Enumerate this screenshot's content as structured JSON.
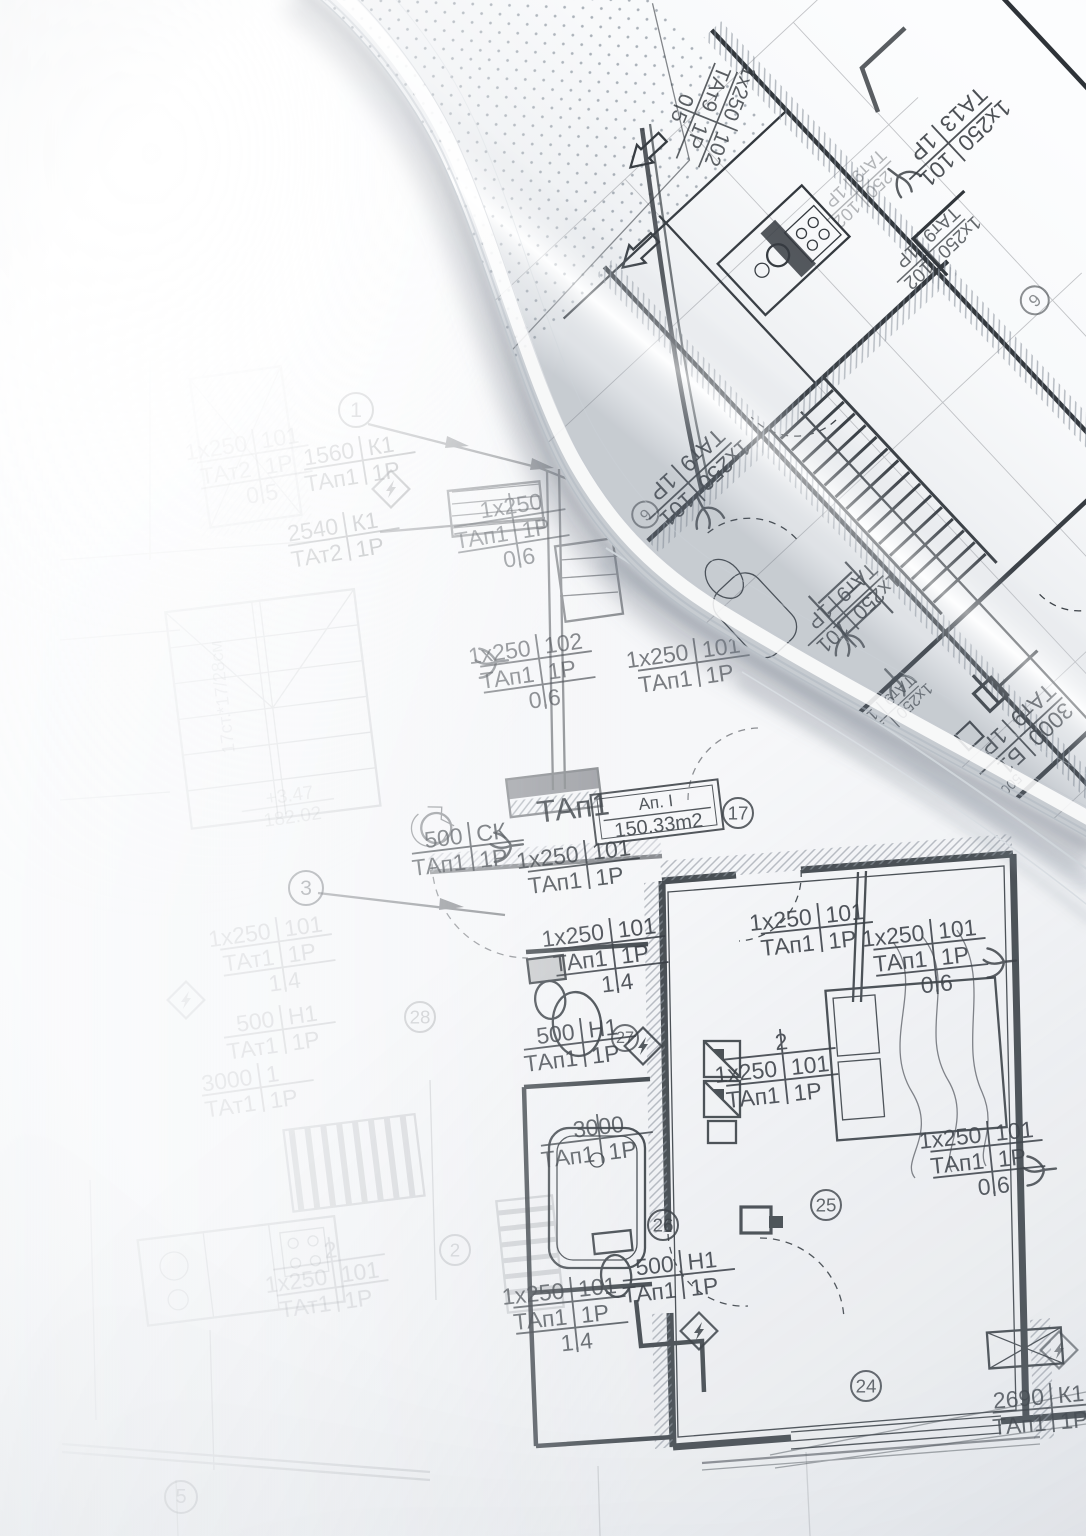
{
  "palette": {
    "ink": "#363b41",
    "roll_ink": "#2e3338",
    "paper": "#f6f7f9",
    "roll_paper": "#fcfdfe",
    "shadow": "#6c7684"
  },
  "flat_plan": {
    "labels": [
      {
        "rows": [
          "1х250|101",
          "ТАт2|1Р",
          "0.5"
        ],
        "x": 255,
        "y": 468,
        "rot": -9,
        "size": 23,
        "o": 0.3
      },
      {
        "rows": [
          "1560|К1",
          "ТАп1|1Р"
        ],
        "x": 360,
        "y": 462,
        "rot": -9,
        "size": 23,
        "o": 0.55
      },
      {
        "rows": [
          "2540|К1",
          "ТАт2|1Р"
        ],
        "x": 344,
        "y": 538,
        "rot": -9,
        "size": 23,
        "o": 0.55
      },
      {
        "rows": [
          "1х250",
          "ТАп1|1Р",
          "0.6"
        ],
        "x": 512,
        "y": 532,
        "rot": -9,
        "size": 23,
        "o": 0.6
      },
      {
        "rows": [
          "1х250|102",
          "ТАп1|1Р",
          "0.6"
        ],
        "x": 538,
        "y": 673,
        "rot": -8,
        "size": 23,
        "o": 0.65
      },
      {
        "rows": [
          "1х250|101",
          "ТАп1|1Р"
        ],
        "x": 694,
        "y": 664,
        "rot": -8,
        "size": 23,
        "o": 0.65
      },
      {
        "rows": [
          "ТАп1"
        ],
        "x": 570,
        "y": 808,
        "rot": -7,
        "size": 31,
        "o": 0.85
      },
      {
        "rows": [
          "500|СК",
          "ТАп1|1Р"
        ],
        "x": 468,
        "y": 848,
        "rot": -7,
        "size": 23,
        "o": 0.8
      },
      {
        "rows": [
          "1х250|101",
          "ТАп1|1Р"
        ],
        "x": 584,
        "y": 866,
        "rot": -7,
        "size": 23,
        "o": 0.85
      },
      {
        "rows": [
          "1х250|101",
          "ТАт1|1Р",
          "1.4"
        ],
        "x": 278,
        "y": 956,
        "rot": -8,
        "size": 23,
        "o": 0.22
      },
      {
        "rows": [
          "500|Н1",
          "ТАт1|1Р"
        ],
        "x": 280,
        "y": 1031,
        "rot": -8,
        "size": 23,
        "o": 0.22
      },
      {
        "rows": [
          "3000|1",
          "ТАт1|1Р"
        ],
        "x": 258,
        "y": 1089,
        "rot": -8,
        "size": 23,
        "o": 0.22
      },
      {
        "rows": [
          "1х250|101",
          "ТАп1|1Р",
          "1.4"
        ],
        "x": 611,
        "y": 957,
        "rot": -7,
        "size": 23,
        "o": 0.88
      },
      {
        "rows": [
          "500|Н1",
          "ТАп1|1Р"
        ],
        "x": 580,
        "y": 1044,
        "rot": -7,
        "size": 23,
        "o": 0.88
      },
      {
        "rows": [
          "1х250|101",
          "ТАп1|1Р"
        ],
        "x": 817,
        "y": 929,
        "rot": -6,
        "size": 23,
        "o": 0.88
      },
      {
        "rows": [
          "1х250|101",
          "ТАп1|1Р",
          "0.6"
        ],
        "x": 931,
        "y": 958,
        "rot": -6,
        "size": 23,
        "o": 0.88
      },
      {
        "rows": [
          "2",
          "1х250|101",
          "ТАп1|1Р"
        ],
        "x": 781,
        "y": 1068,
        "rot": -6,
        "size": 23,
        "o": 0.88
      },
      {
        "rows": [
          "3000",
          "ТАп1|1Р"
        ],
        "x": 597,
        "y": 1140,
        "rot": -7,
        "size": 23,
        "o": 0.8
      },
      {
        "rows": [
          "1х250|101",
          "ТАп1|1Р",
          "0.6"
        ],
        "x": 988,
        "y": 1160,
        "rot": -6,
        "size": 23,
        "o": 0.88
      },
      {
        "rows": [
          "500|Н1",
          "ТАп1|1Р"
        ],
        "x": 679,
        "y": 1276,
        "rot": -6,
        "size": 23,
        "o": 0.88
      },
      {
        "rows": [
          "1х250|101",
          "ТАп1|1Р",
          "1.4"
        ],
        "x": 571,
        "y": 1316,
        "rot": -6,
        "size": 23,
        "o": 0.8
      },
      {
        "rows": [
          "2",
          "1х250|101",
          "ТАт1|1Р"
        ],
        "x": 331,
        "y": 1276,
        "rot": -8,
        "size": 23,
        "o": 0.2
      },
      {
        "rows": [
          "2690|К1",
          "ТАп1|1Р"
        ],
        "x": 1049,
        "y": 1409,
        "rot": -5,
        "size": 23,
        "o": 0.8
      },
      {
        "rows": [
          "+3.47",
          "182.02"
        ],
        "x": 288,
        "y": 806,
        "rot": -8,
        "size": 19,
        "o": 0.14
      },
      {
        "rows": [
          "17ст.*17/28см"
        ],
        "x": 222,
        "y": 700,
        "rot": -97,
        "size": 18,
        "o": 0.16
      }
    ],
    "area_box": {
      "rows": [
        "Ап. I",
        "150.33m2"
      ],
      "x": 657,
      "y": 812,
      "rot": -7,
      "o": 0.85
    },
    "circles": [
      {
        "n": "1",
        "x": 356,
        "y": 410,
        "r": 17,
        "o": 0.55
      },
      {
        "n": "3",
        "x": 306,
        "y": 888,
        "r": 17,
        "o": 0.6
      },
      {
        "n": "17",
        "x": 738,
        "y": 813,
        "r": 15,
        "o": 0.8
      },
      {
        "n": "28",
        "x": 420,
        "y": 1017,
        "r": 15,
        "o": 0.25
      },
      {
        "n": "27",
        "x": 625,
        "y": 1038,
        "r": 13,
        "o": 0.75
      },
      {
        "n": "2",
        "x": 455,
        "y": 1250,
        "r": 15,
        "o": 0.2
      },
      {
        "n": "26",
        "x": 663,
        "y": 1225,
        "r": 15,
        "o": 0.85
      },
      {
        "n": "25",
        "x": 826,
        "y": 1205,
        "r": 15,
        "o": 0.8
      },
      {
        "n": "24",
        "x": 866,
        "y": 1386,
        "r": 15,
        "o": 0.8
      },
      {
        "n": "5",
        "x": 181,
        "y": 1497,
        "r": 16,
        "o": 0.3
      }
    ],
    "symbols": [
      {
        "type": "lightning",
        "x": 643,
        "y": 1046,
        "o": 0.85
      },
      {
        "type": "lightning",
        "x": 699,
        "y": 1331,
        "o": 0.85
      },
      {
        "type": "lightning",
        "x": 391,
        "y": 489,
        "o": 0.5
      },
      {
        "type": "lightning",
        "x": 186,
        "y": 1000,
        "o": 0.2
      },
      {
        "type": "lightning",
        "x": 1059,
        "y": 1350,
        "o": 0.6
      },
      {
        "type": "trident",
        "x": 509,
        "y": 846,
        "rot": -97,
        "o": 0.8
      },
      {
        "type": "trident",
        "x": 494,
        "y": 662,
        "rot": -97,
        "o": 0.6
      },
      {
        "type": "trident",
        "x": 1002,
        "y": 962,
        "rot": -96,
        "o": 0.85
      },
      {
        "type": "trident",
        "x": 1042,
        "y": 1170,
        "rot": -96,
        "o": 0.85
      }
    ]
  },
  "rolled_plan": {
    "labels": [
      {
        "rows": [
          "1х250|102",
          "ТАт9|1Р",
          "0.5"
        ],
        "x": -183,
        "y": 192,
        "rot": -25,
        "size": 21,
        "o": 0.8
      },
      {
        "rows": [
          "1х250|101",
          "ТА13|1Р"
        ],
        "x": -344,
        "y": 7,
        "rot": 0,
        "size": 23,
        "o": 0.85
      },
      {
        "rows": [
          "1х250|102",
          "ТАт9|1Р"
        ],
        "x": -255,
        "y": -60,
        "rot": 0,
        "size": 19,
        "o": 0.75
      },
      {
        "rows": [
          "250|102",
          "ТАт9|1Р"
        ],
        "x": -243,
        "y": 33,
        "rot": 0,
        "size": 18,
        "o": 0.35
      },
      {
        "rows": [
          "1х250|101",
          "ТАт9|1Р"
        ],
        "x": 78,
        "y": -64,
        "rot": 0,
        "size": 23,
        "o": 0.9
      },
      {
        "rows": [
          "1х250|101",
          "ТАт9|1Р"
        ],
        "x": 53,
        "y": -265,
        "rot": 0,
        "size": 21,
        "o": 0.85
      },
      {
        "rows": [
          "1х250|102",
          "ТАт9|1Р"
        ],
        "x": 90,
        "y": -370,
        "rot": 0,
        "size": 16,
        "o": 0.75
      },
      {
        "rows": [
          "3000|Б1",
          "ТАт9|1Р"
        ],
        "x": 10,
        "y": -476,
        "rot": 0,
        "size": 23,
        "o": 0.9
      },
      {
        "rows": [
          "500|А4"
        ],
        "x": 66,
        "y": -506,
        "rot": 0,
        "size": 14,
        "o": 0.75
      },
      {
        "rows": [
          "1%"
        ],
        "x": 166,
        "y": 186,
        "rot": -20,
        "size": 19,
        "o": 0.5
      }
    ],
    "circles": [
      {
        "n": "6",
        "x": 134,
        "y": -59,
        "r": 13,
        "o": 0.6
      },
      {
        "n": "6",
        "x": -297,
        "y": -168,
        "r": 14,
        "o": 0.55
      }
    ],
    "symbols": [
      {
        "type": "trident",
        "x": 88,
        "y": -96,
        "rot": 15,
        "o": 0.85
      },
      {
        "type": "trident",
        "x": -282,
        "y": 14,
        "rot": -10,
        "o": 0.8
      },
      {
        "type": "trident",
        "x": 72,
        "y": -285,
        "rot": 20,
        "o": 0.8
      },
      {
        "type": "trident",
        "x": 64,
        "y": -350,
        "rot": 0,
        "o": 0.7
      }
    ]
  }
}
